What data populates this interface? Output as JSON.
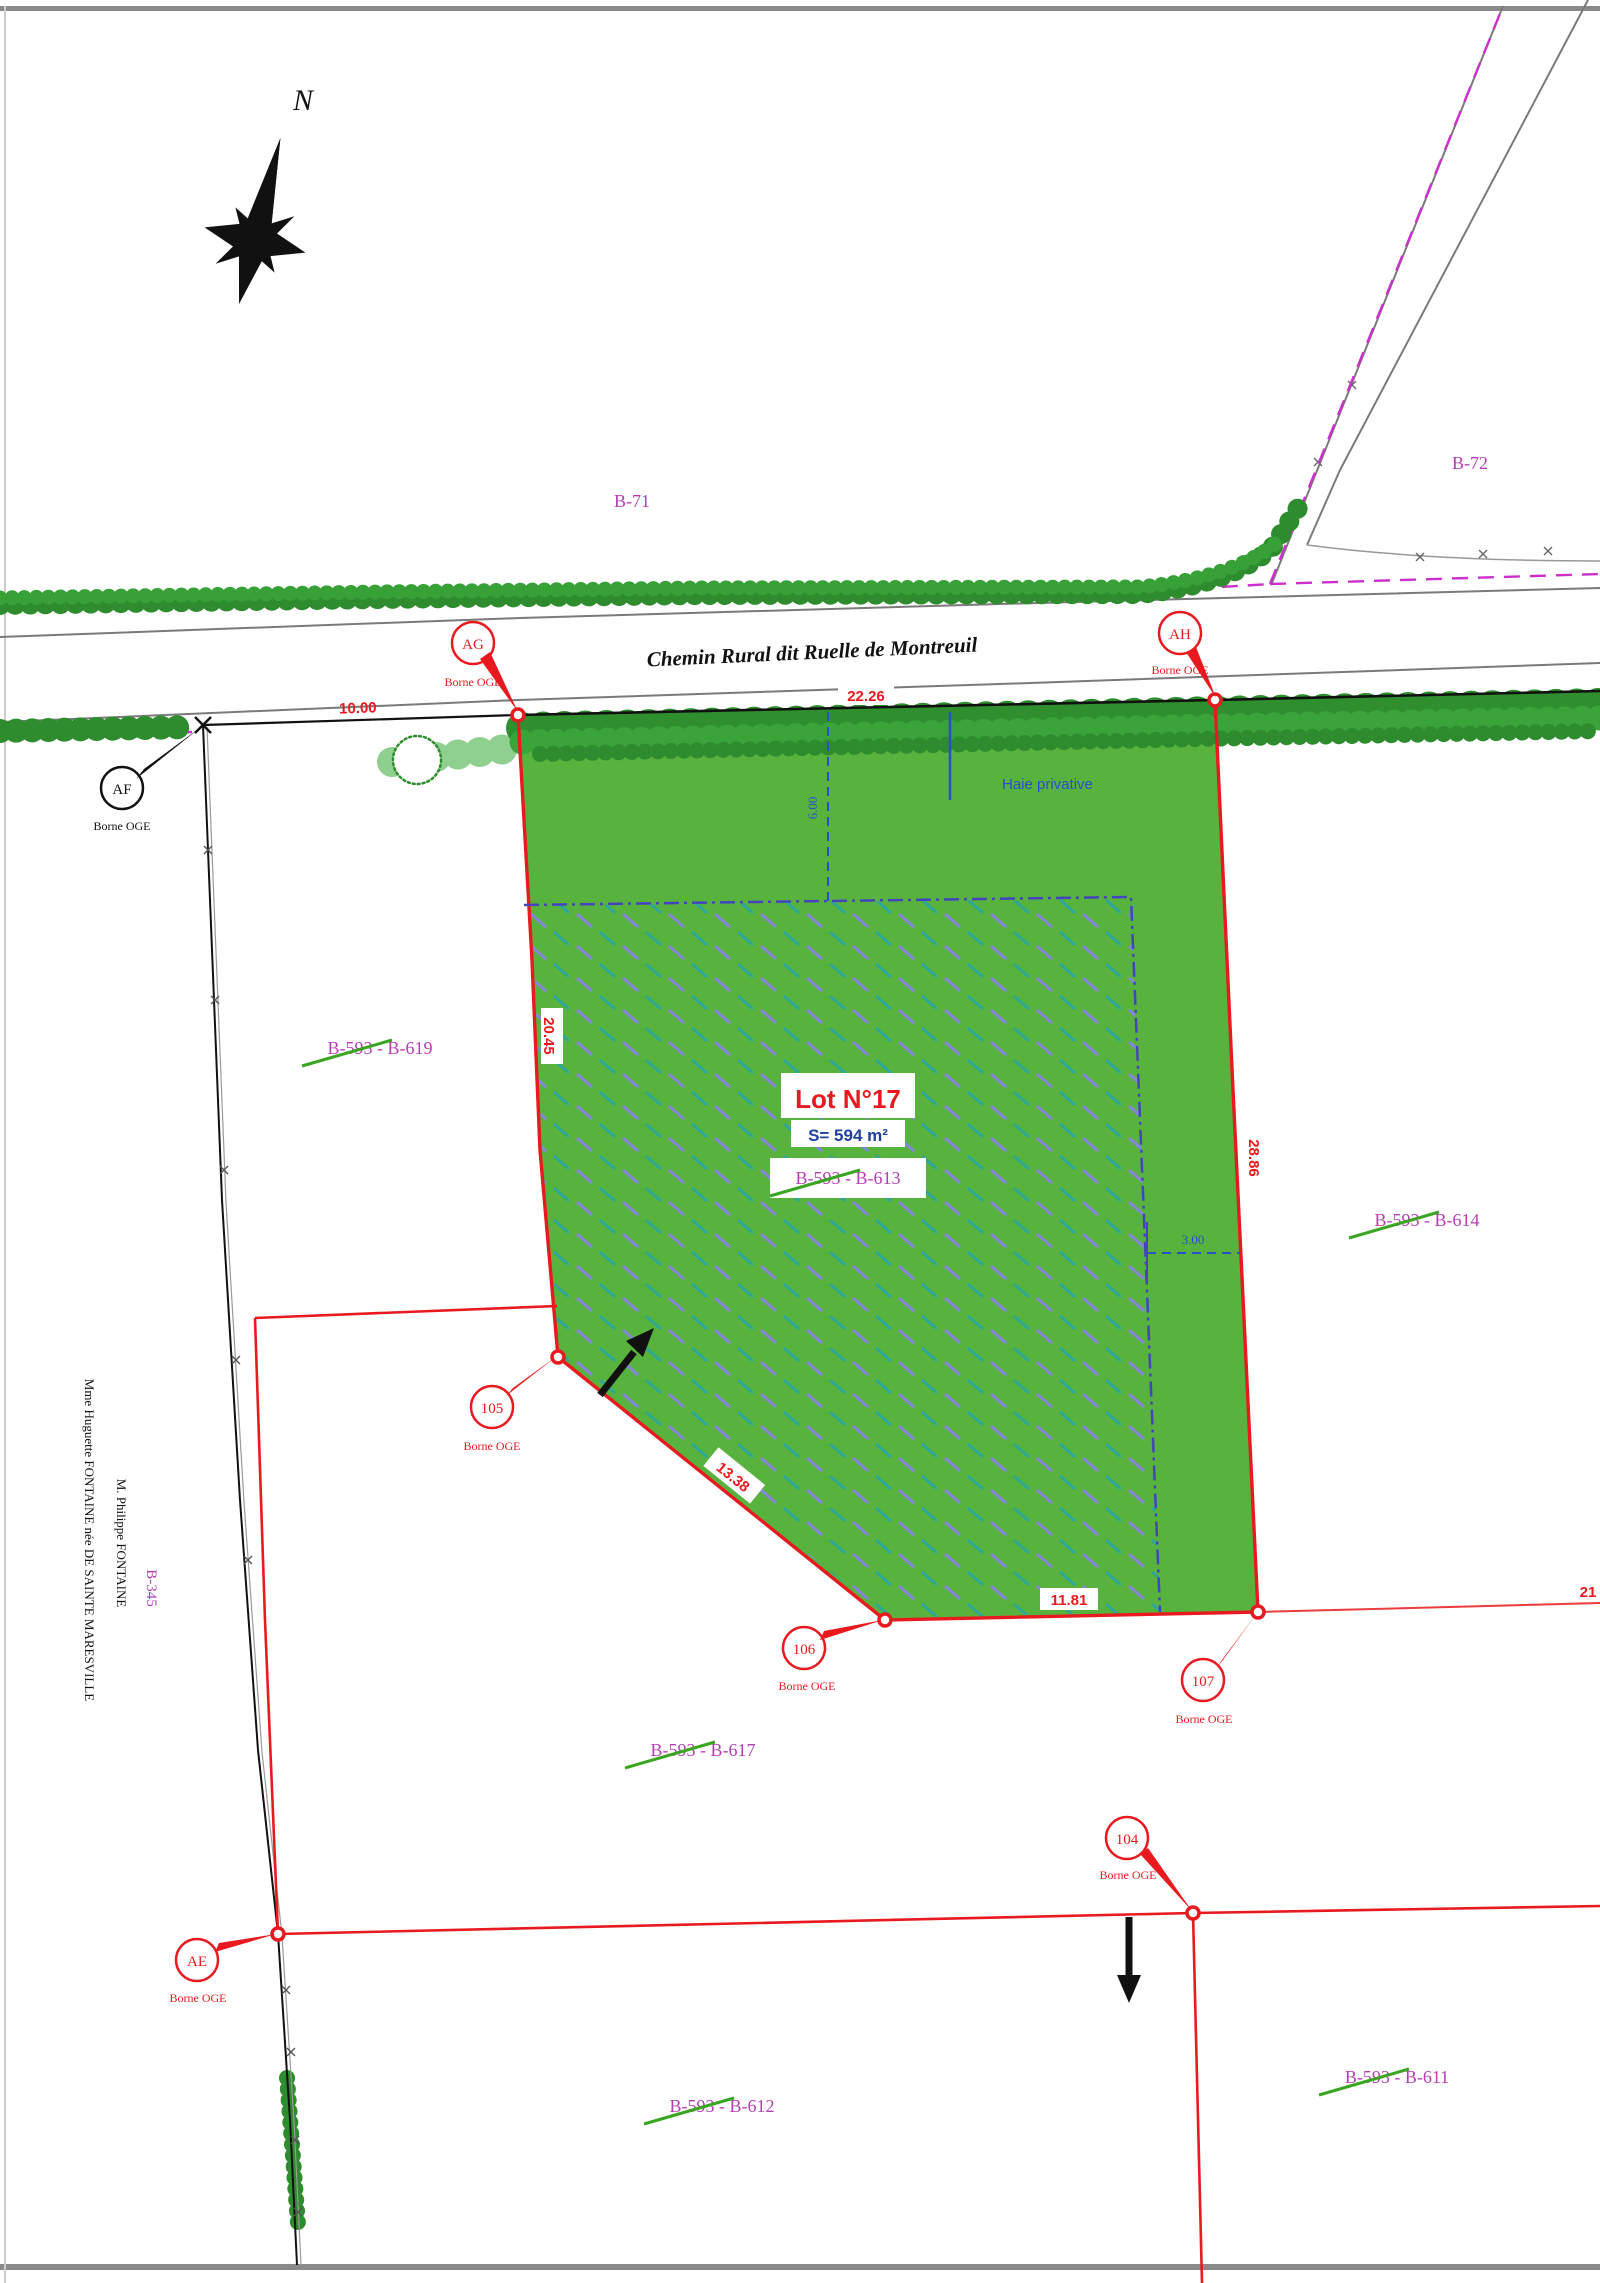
{
  "map": {
    "north_label": "N",
    "road_name": "Chemin Rural dit Ruelle de Montreuil",
    "hedge_label": "Haie privative",
    "borne_label": "Borne OGE",
    "lot": {
      "title": "Lot N°17",
      "area": "S= 594 m²"
    },
    "zones": {
      "b71": "B-71",
      "b72": "B-72",
      "b345": "B-345"
    },
    "owners": {
      "line1": "Mme Huguette FONTAINE née DE SAINTE MARESVILLE",
      "line2": "M. Philippe FONTAINE"
    },
    "markers": {
      "ag": "AG",
      "ah": "AH",
      "af": "AF",
      "ae": "AE",
      "m104": "104",
      "m105": "105",
      "m106": "106",
      "m107": "107"
    },
    "parcels": {
      "p619": {
        "old": "B-593",
        "rest": " - B-619"
      },
      "p613": {
        "old": "B-593",
        "rest": " - B-613"
      },
      "p614": {
        "old": "B-593",
        "rest": " - B-614"
      },
      "p617": {
        "old": "B-593",
        "rest": " - B-617"
      },
      "p612": {
        "old": "B-593",
        "rest": " - B-612"
      },
      "p611": {
        "old": "B-593",
        "rest": " - B-611"
      }
    },
    "measurements": {
      "af_ag": "10.00",
      "frontage": "22.26",
      "west": "20.45",
      "east": "28.86",
      "diagonal": "13.38",
      "south": "11.81",
      "east_line": "21",
      "hedge_depth": "6.00",
      "offset": "3.00"
    },
    "colors": {
      "boundary_red": "#e81a1f",
      "parcel_green": "#57b33d",
      "label_magenta": "#b43db4",
      "measure_blue": "#2850c8",
      "tree_green": "#2e8b2e",
      "dashdot_blue": "#4444bc"
    }
  }
}
